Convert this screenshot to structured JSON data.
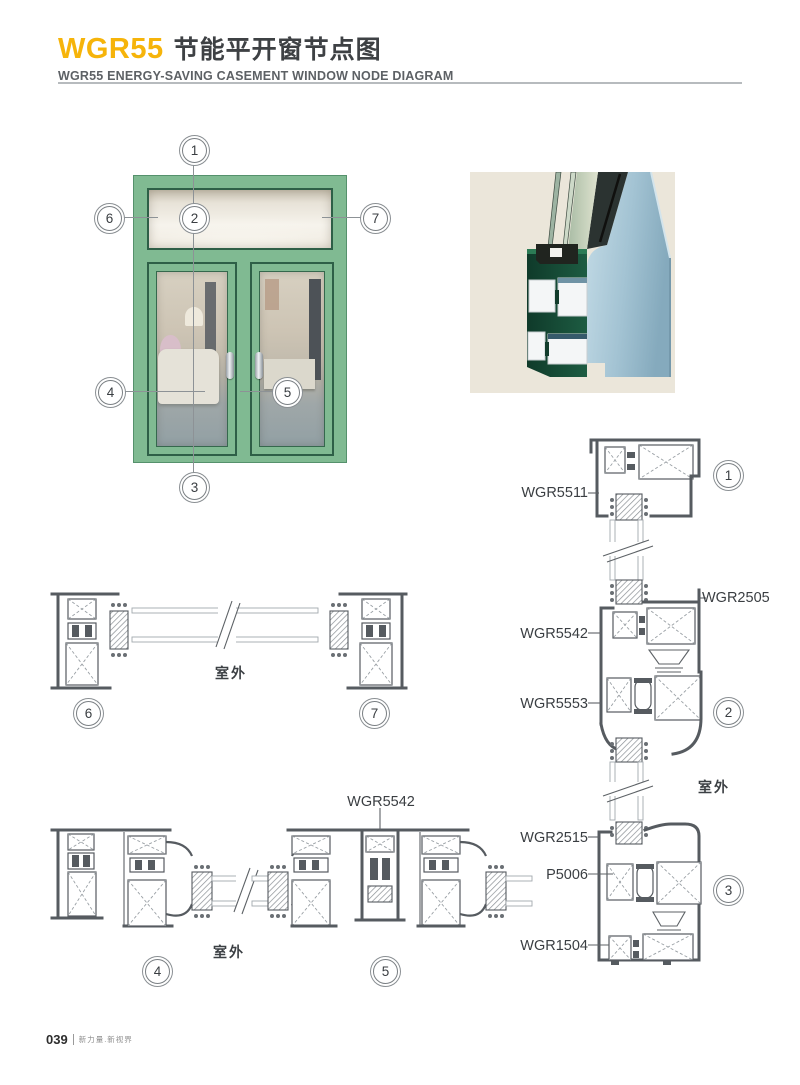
{
  "header": {
    "brand": "WGR55",
    "title_cn": "节能平开窗节点图",
    "subtitle": "WGR55 ENERGY-SAVING CASEMENT WINDOW NODE DIAGRAM"
  },
  "callouts": {
    "n1": "1",
    "n2": "2",
    "n3": "3",
    "n4": "4",
    "n5": "5",
    "n6": "6",
    "n7": "7"
  },
  "part_labels": {
    "wgr5511": "WGR5511",
    "wgr2505": "WGR2505",
    "wgr5542": "WGR5542",
    "wgr5553": "WGR5553",
    "wgr2515": "WGR2515",
    "p5006": "P5006",
    "wgr1504": "WGR1504"
  },
  "annotations": {
    "outdoor": "室外"
  },
  "footer": {
    "page_no": "039",
    "tagline": "新力量.新视界"
  },
  "colors": {
    "accent": "#f6b40a",
    "window_green": "#80ba92",
    "profile_blue": "#a3c3d3",
    "profile_core_green": "#17503a",
    "drawing_line": "#565b60"
  }
}
